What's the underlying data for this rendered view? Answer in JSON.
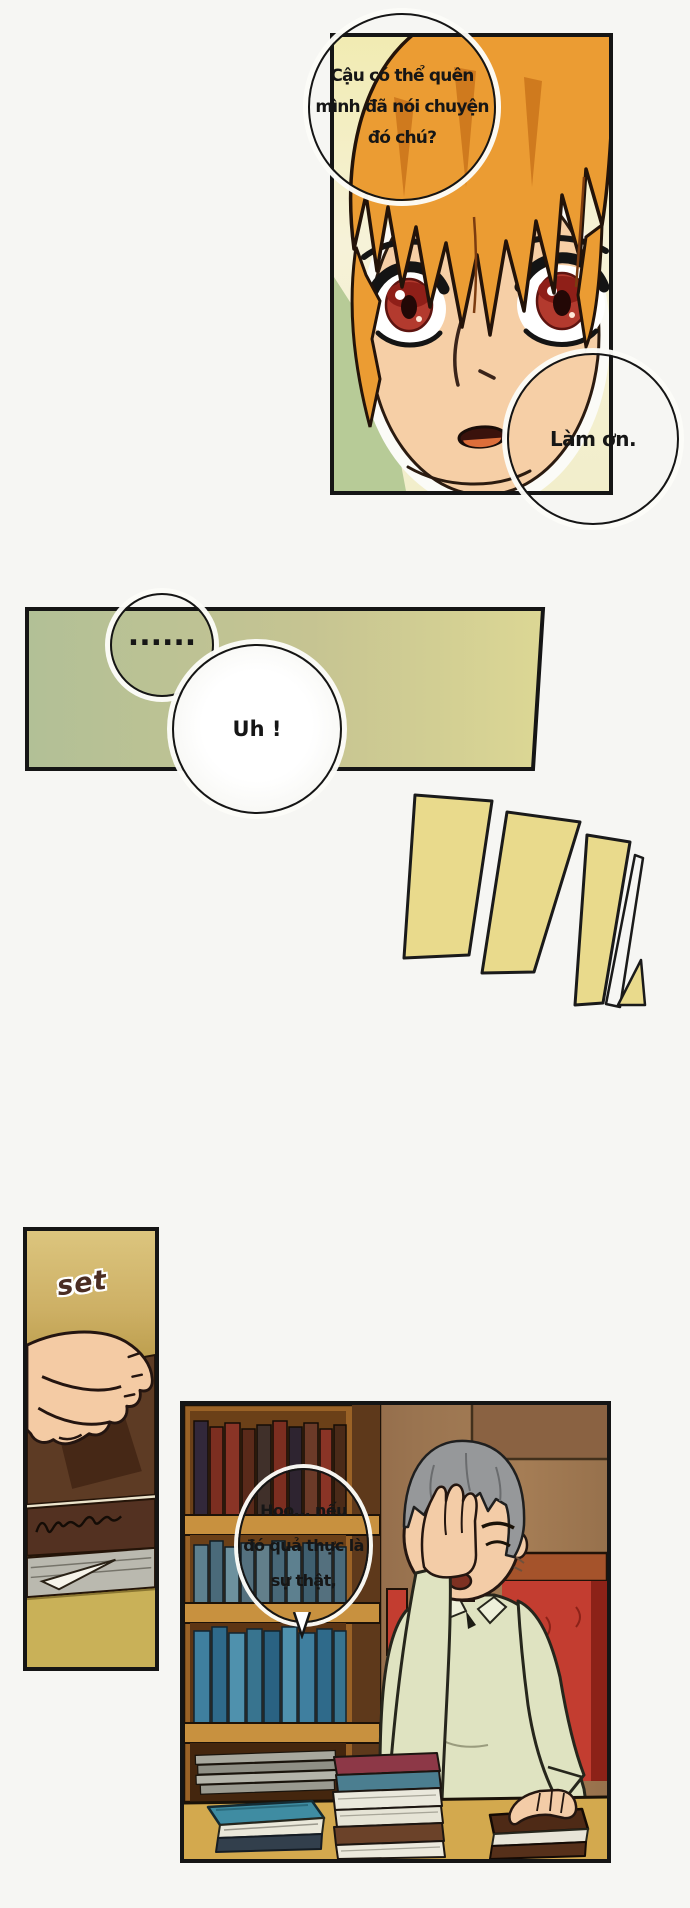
{
  "page": {
    "type": "comic-page",
    "language": "Vietnamese"
  },
  "bubbles": {
    "question": {
      "line1": "Cậu có thể quên",
      "line2": "mình đã nói chuyện",
      "line3": "đó chú?"
    },
    "plea": {
      "text": "Làm ơn."
    },
    "dots": {
      "text": "......"
    },
    "uh": {
      "text": "Uh !"
    },
    "musing": {
      "line1": "Hoo... nếu",
      "line2": "đó quả thực là",
      "line3": "sự thật,"
    }
  },
  "sfx": {
    "set": "set"
  },
  "colors": {
    "page_bg": "#f6f6f3",
    "panel_border": "#151515",
    "stripe_yellow": "#e9da8c",
    "pause_panel_green": "#b2c096",
    "pause_panel_yellow": "#dcd794",
    "face_panel_yellow": "#f1ebb2",
    "hair_orange": "#eb9c33",
    "eye_red": "#b33a2e",
    "skin": "#f4cba4",
    "sfx_panel_gold": "#c9ac5e",
    "book_brown": "#5d3b24",
    "wall_brown": "#96714d",
    "shelf_wood": "#9a6226",
    "chair_red": "#c33d30",
    "shirt_green": "#dfe3c1",
    "desk_mustard": "#d3a94e",
    "old_man_hair_gray": "#96989a"
  }
}
